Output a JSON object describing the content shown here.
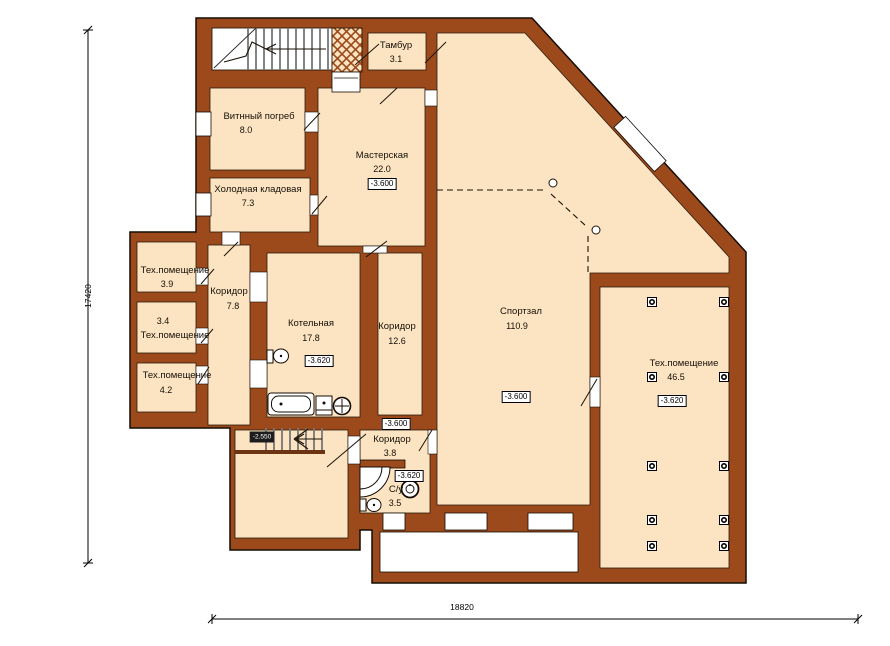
{
  "title": "План подвального этажа",
  "dimensions": {
    "height_mm": "17420",
    "width_mm": "18820"
  },
  "stair_level": "-2.550",
  "colors": {
    "wall": "#9c4a1c",
    "floor": "#fce4c2",
    "outline": "#140c04",
    "paper": "#ffffff"
  },
  "rooms": [
    {
      "name": "Тамбур",
      "area": "3.1"
    },
    {
      "name": "Витнный погреб",
      "area": "8.0"
    },
    {
      "name": "Мастерская",
      "area": "22.0",
      "level": "-3.600"
    },
    {
      "name": "Холодная кладовая",
      "area": "7.3"
    },
    {
      "name": "Тех.помещение",
      "area": "3.9"
    },
    {
      "name": "Коридор",
      "area": "7.8"
    },
    {
      "name": "Тех.помещение",
      "area": "3.4"
    },
    {
      "name": "Тех.помещение",
      "area": "4.2"
    },
    {
      "name": "Котельная",
      "area": "17.8",
      "level": "-3.620"
    },
    {
      "name": "Коридор",
      "area": "12.6"
    },
    {
      "name": "Спортзал",
      "area": "110.9",
      "level": "-3.600"
    },
    {
      "name": "Тех.помещение",
      "area": "46.5",
      "level": "-3.620"
    },
    {
      "name": "Коридор",
      "area": "3.8",
      "level": "-3.600"
    },
    {
      "name": "С/у",
      "area": "3.5",
      "level": "-3.620"
    }
  ]
}
